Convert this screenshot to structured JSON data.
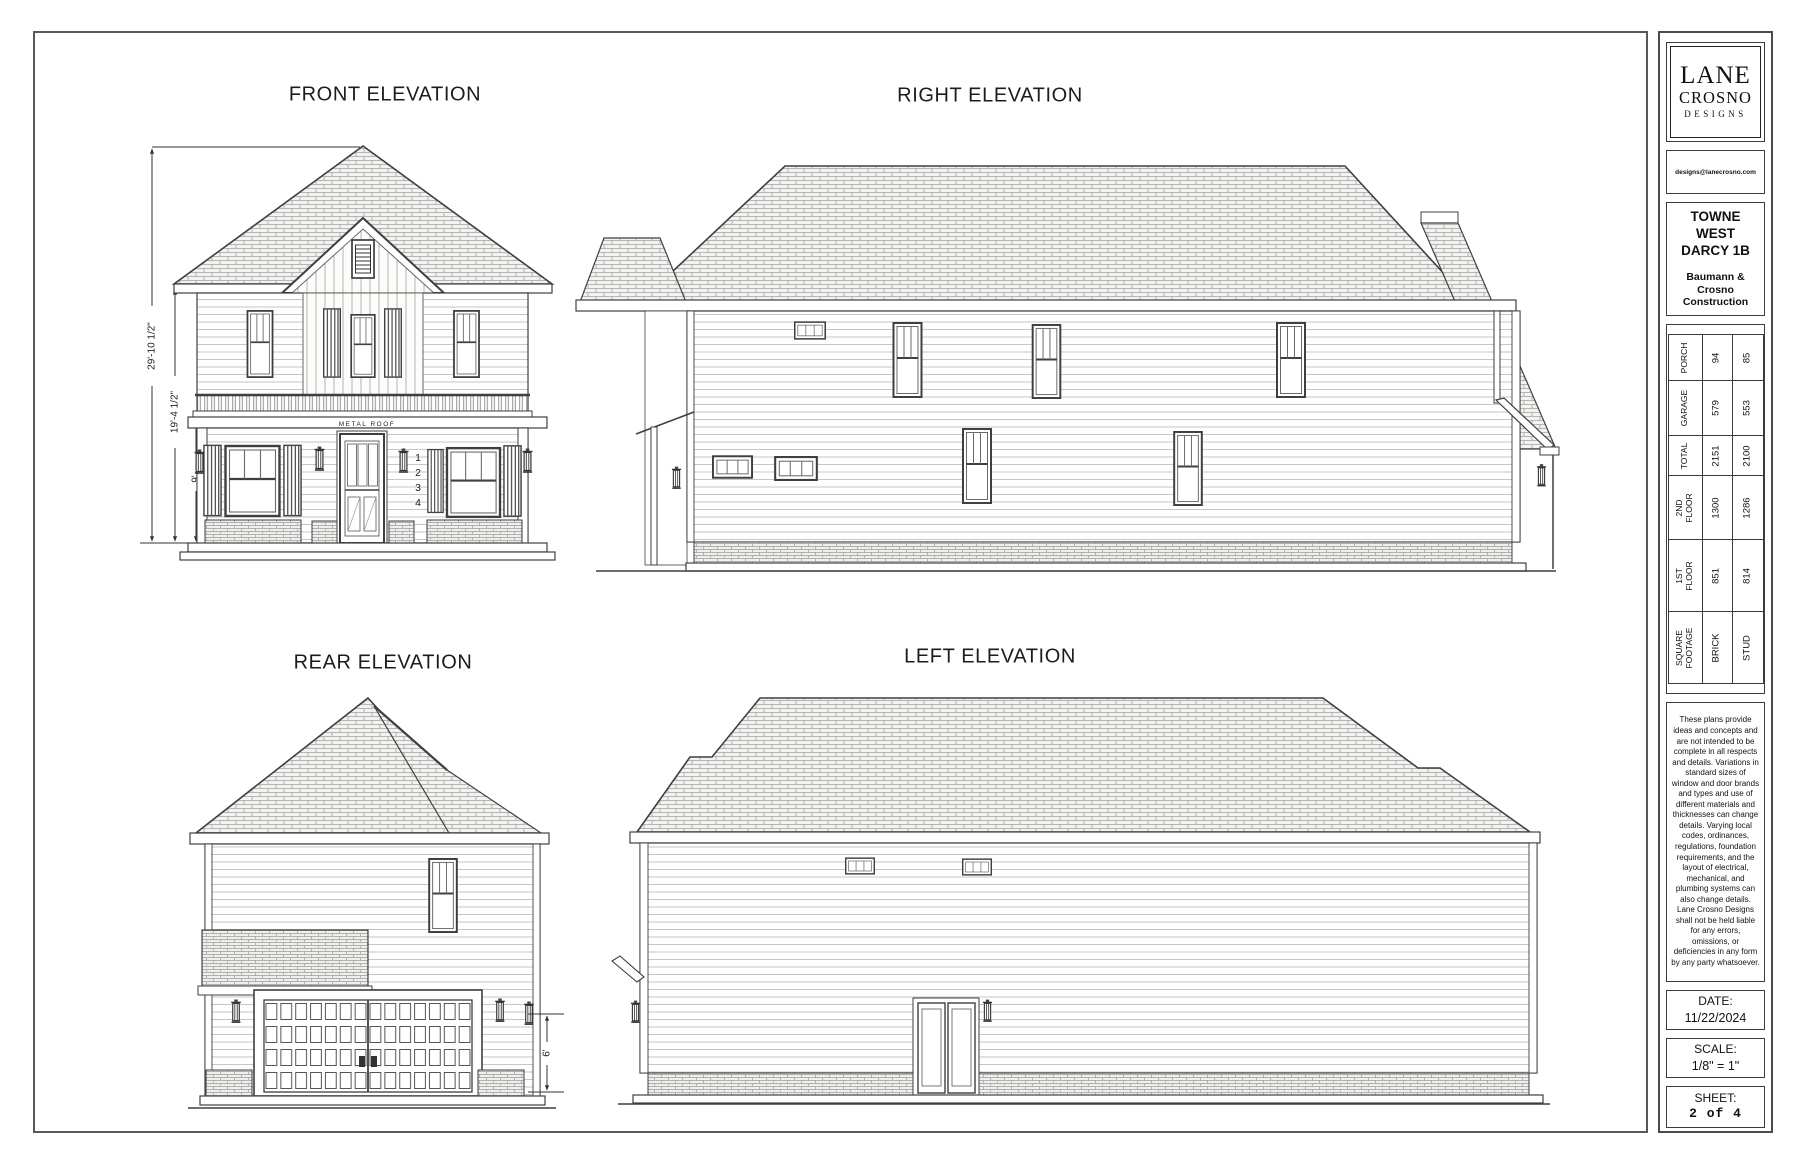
{
  "elevations": {
    "front": {
      "title": "FRONT ELEVATION",
      "dim_overall": "29'-10 1/2\"",
      "dim_second": "19'-4 1/2\"",
      "dim_first": "9'",
      "metal_roof_label": "METAL ROOF",
      "house_number": "1234"
    },
    "right": {
      "title": "RIGHT ELEVATION"
    },
    "rear": {
      "title": "REAR ELEVATION",
      "dim_garage": "6'"
    },
    "left": {
      "title": "LEFT ELEVATION"
    }
  },
  "title_block": {
    "logo_line1": "LANE",
    "logo_line2": "CROSNO",
    "logo_line3": "DESIGNS",
    "email": "designs@lanecrosno.com",
    "project_name": "TOWNE WEST DARCY 1B",
    "builder": "Baumann & Crosno Construction",
    "sqft_table": {
      "rows": [
        {
          "label": "PORCH",
          "brick": "94",
          "stud": "85"
        },
        {
          "label": "GARAGE",
          "brick": "579",
          "stud": "553"
        },
        {
          "label": "TOTAL",
          "brick": "2151",
          "stud": "2100"
        },
        {
          "label": "2ND FLOOR",
          "brick": "1300",
          "stud": "1286"
        },
        {
          "label": "1ST FLOOR",
          "brick": "851",
          "stud": "814"
        },
        {
          "label": "SQUARE\nFOOTAGE",
          "brick": "BRICK",
          "stud": "STUD"
        }
      ]
    },
    "disclaimer": "These plans provide ideas and concepts and are not intended to be complete in all respects and details. Variations in standard sizes of window and door brands and types and use of different materials and thicknesses can change details. Varying local codes, ordinances, regulations, foundation requirements, and the layout of electrical, mechanical, and plumbing systems can also change details. Lane Crosno Designs shall not be held liable for any errors, omissions, or deficiencies in any form by any party whatsoever.",
    "date_label": "DATE:",
    "date_value": "11/22/2024",
    "scale_label": "SCALE:",
    "scale_value": "1/8\" = 1\"",
    "sheet_label": "SHEET:",
    "sheet_value": "2 of 4"
  }
}
